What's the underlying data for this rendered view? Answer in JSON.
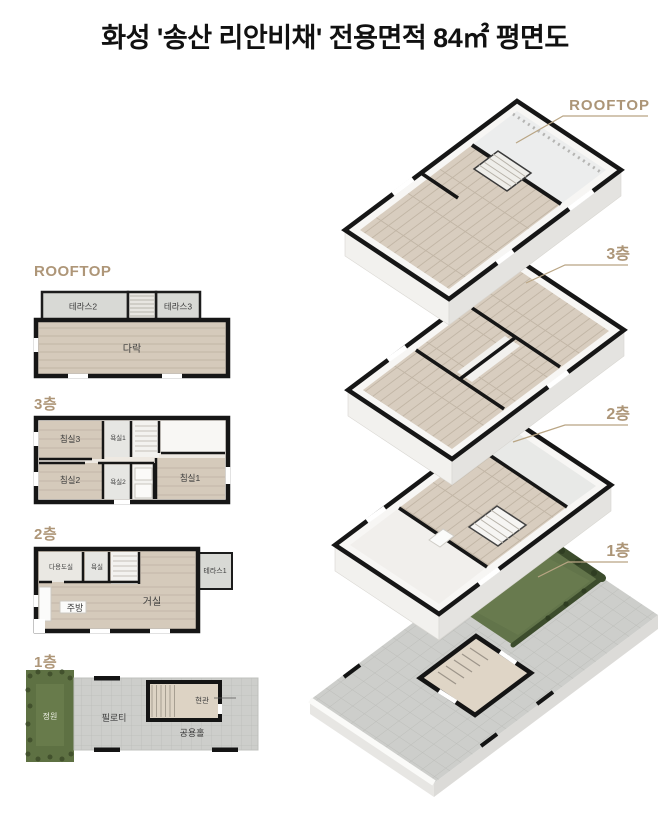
{
  "title": "화성 '송산 리안비채' 전용면적 84㎡ 평면도",
  "colors": {
    "accent_label": "#ac9577",
    "wall": "#161616",
    "wood_floor": "#d5cabb",
    "terrace_grey": "#d8d9d5",
    "paving_grey": "#cdcecb",
    "garden_green": "#5e7143"
  },
  "plans_2d": {
    "rooftop": {
      "label": "ROOFTOP",
      "rooms": {
        "terrace2": "테라스2",
        "terrace3": "테라스3",
        "attic": "다락"
      }
    },
    "floor3": {
      "label": "3층",
      "rooms": {
        "bedroom3": "침실3",
        "bath1": "욕실1",
        "bedroom2": "침실2",
        "bath2": "욕실2",
        "bedroom1": "침실1"
      }
    },
    "floor2": {
      "label": "2층",
      "rooms": {
        "utility": "다용도실",
        "bath": "욕실",
        "terrace1": "테라스1",
        "kitchen": "주방",
        "living": "거실"
      }
    },
    "floor1": {
      "label": "1층",
      "rooms": {
        "garden": "정원",
        "piloti": "필로티",
        "common_hall": "공용홀",
        "entrance": "현관"
      }
    }
  },
  "iso_3d": {
    "labels": {
      "rooftop": "ROOFTOP",
      "floor3": "3층",
      "floor2": "2층",
      "floor1": "1층"
    }
  }
}
